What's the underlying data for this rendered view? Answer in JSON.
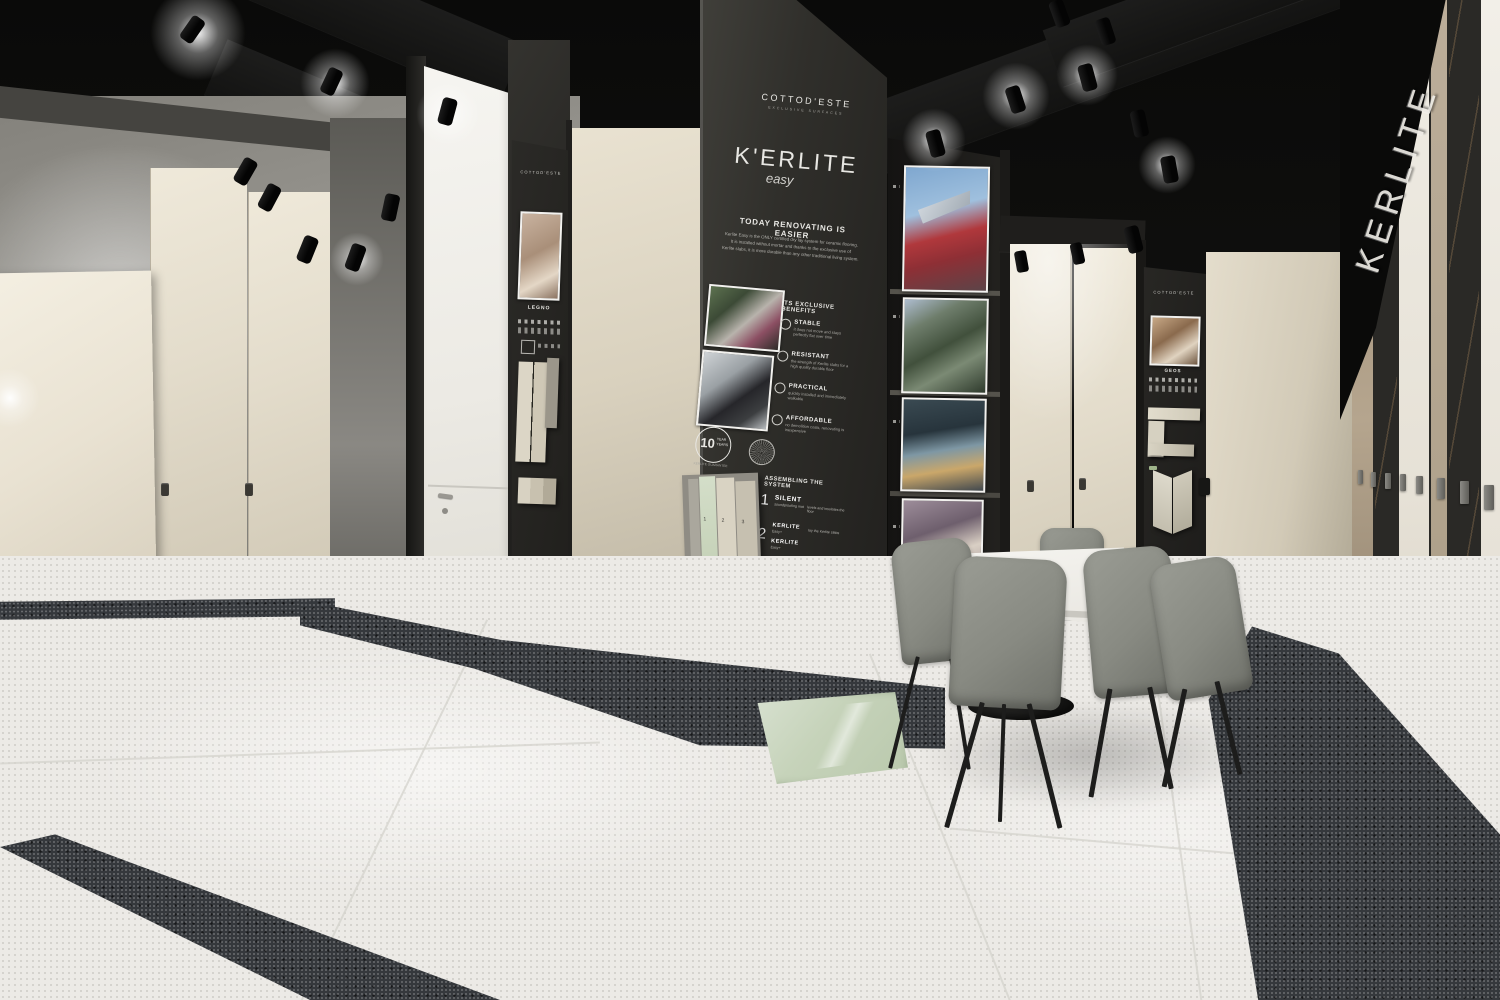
{
  "scene": {
    "title": "Cottod'Este Kerlite Easy tile showroom"
  },
  "pillar": {
    "brand": "COTTOD'ESTE",
    "brand_tagline": "EXCLUSIVE SURFACES",
    "product": "K'ERLITE",
    "product_variant": "easy",
    "headline": "TODAY RENOVATING IS EASIER",
    "intro_lines": [
      "Kerlite Easy is the ONLY certified dry lay system for ceramic flooring.",
      "It is installed without mortar and thanks to the exclusive use of",
      "Kerlite slabs, it is more durable than any other traditional living system."
    ],
    "benefits_title": "ITS EXCLUSIVE BENEFITS",
    "benefits": [
      {
        "label": "STABLE",
        "desc": "it does not move and stays perfectly flat over time"
      },
      {
        "label": "RESISTANT",
        "desc": "the strength of Kerlite slabs for a high quality durable floor"
      },
      {
        "label": "PRACTICAL",
        "desc": "quickly installed and immediately walkable"
      },
      {
        "label": "AFFORDABLE",
        "desc": "no demolition costs, renovating is inexpensive"
      }
    ],
    "warranty": {
      "value": "10",
      "unit": "YEAR",
      "unit2": "YEARS",
      "note": "KERLITE GUARANTEE"
    },
    "assembly_title": "ASSEMBLING THE SYSTEM",
    "steps": [
      {
        "num": "1",
        "title": "SILENT",
        "sub": "soundproofing mat",
        "note": "levels and insulates the floor"
      },
      {
        "num": "2",
        "title": "KERLITE",
        "sub": "Easy+",
        "note": "lay the Kerlite slabs"
      },
      {
        "num": "",
        "title": "KERLITE",
        "sub": "Easy+",
        "note": ""
      },
      {
        "num": "3",
        "title": "FILLER",
        "sub": "finishing product",
        "note": "seals the gaps"
      }
    ],
    "board": {
      "labels": [
        "1",
        "2",
        "3"
      ],
      "brand": "KERLITE",
      "brand_sub": "easy"
    }
  },
  "left_display": {
    "brand": "COTTOD'ESTE",
    "collection": "LEGNO"
  },
  "right_display": {
    "brand": "COTTOD'ESTE",
    "collection": "GEOS"
  },
  "marble_wall": {
    "letters": "KERLITE"
  },
  "photo_column": {
    "photos": [
      "angular red building",
      "vertical forest towers",
      "poolside villa at dusk",
      "curved interior"
    ]
  },
  "colors": {
    "accent_green_tile": "#c8d4ba",
    "panel_dark": "#2e2d2a",
    "beige_panel": "#e7e0d0",
    "floor": "#eceae6",
    "granite_strip": "#35383c"
  }
}
